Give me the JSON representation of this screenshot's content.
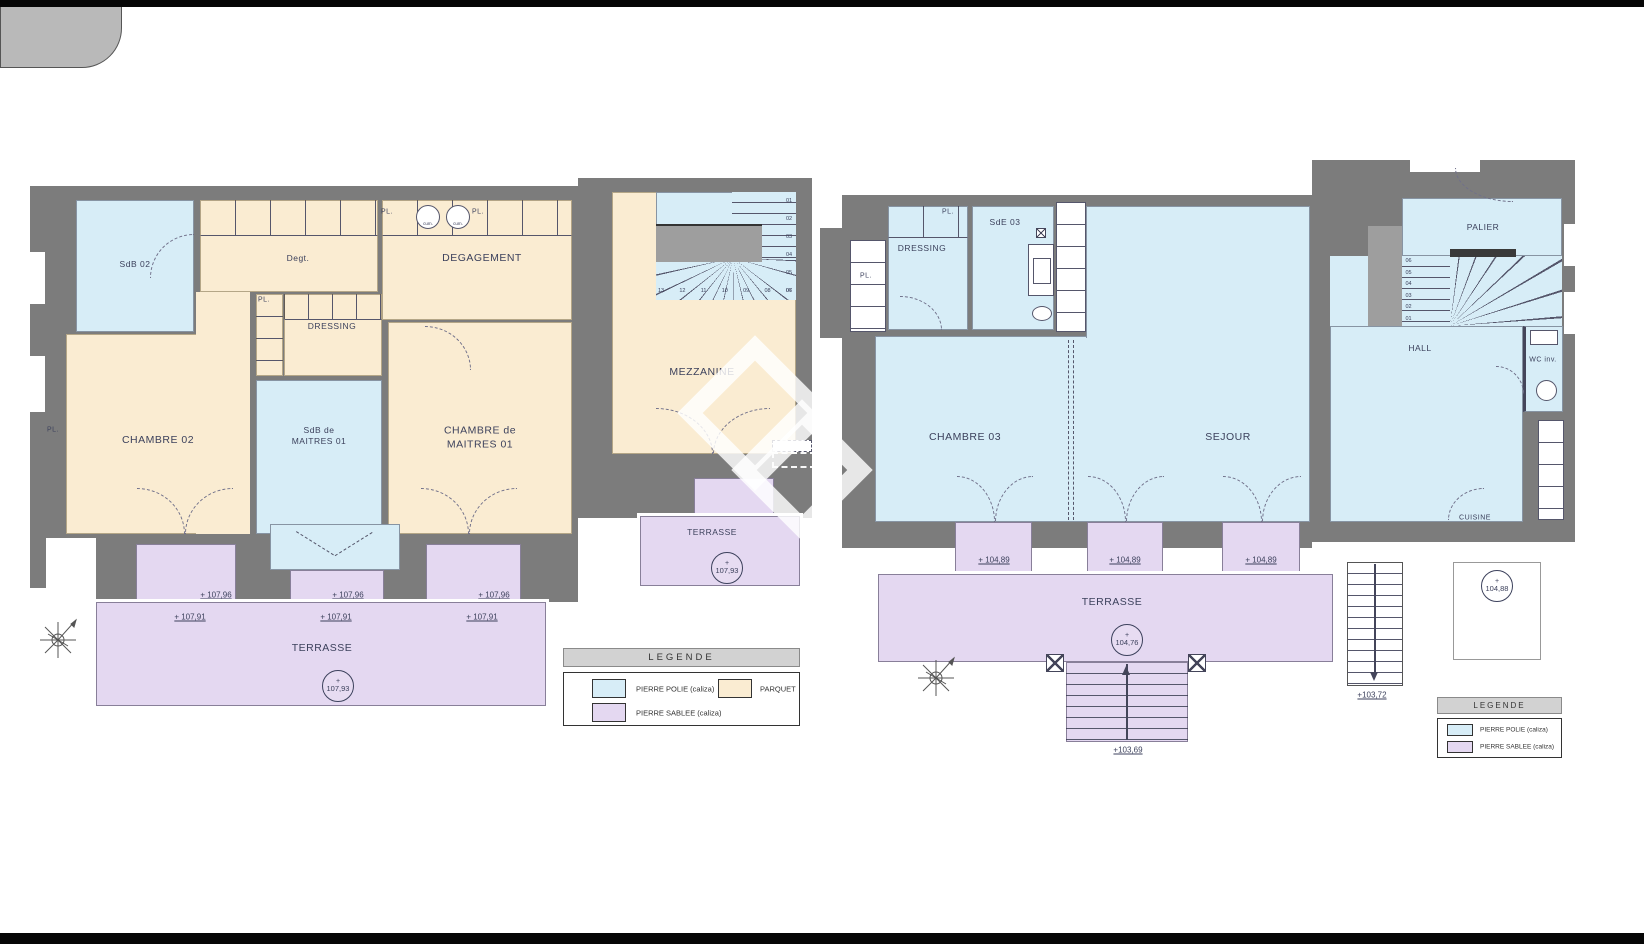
{
  "plus": "+",
  "colors": {
    "wall": "#7c7c7c",
    "pierre_polie": "#d7edf7",
    "parquet": "#faecd2",
    "pierre_sablee": "#e4d8f1",
    "text": "#3c415c"
  },
  "left": {
    "rooms": {
      "sdb02": "SdB 02",
      "degt": "Degt.",
      "degagement": "DEGAGEMENT",
      "dressing": "DRESSING",
      "chambre02": "CHAMBRE 02",
      "sdb_maitres": "SdB de MAITRES 01",
      "chambre_maitres": "CHAMBRE de MAITRES 01",
      "mezzanine": "MEZZANINE",
      "terrasse_small": "TERRASSE",
      "terrasse": "TERRASSE"
    },
    "pl": [
      "PL.",
      "PL.",
      "PL.",
      "PL."
    ],
    "cum": [
      "cum.",
      "cum."
    ],
    "stairs_bottom": [
      "13",
      "12",
      "11",
      "10",
      "09",
      "08",
      "07"
    ],
    "stairs_right": [
      "01",
      "02",
      "03",
      "04",
      "05",
      "06"
    ],
    "elev": {
      "circle_small": "107,93",
      "circle_main": "107,93",
      "e96": [
        "+ 107,96",
        "+ 107,96",
        "+ 107,96"
      ],
      "e91": [
        "+ 107,91",
        "+ 107,91",
        "+ 107,91"
      ]
    },
    "legend": {
      "title": "LEGENDE",
      "items": [
        {
          "label": "PIERRE POLIE (caliza)",
          "color": "#d7edf7"
        },
        {
          "label": "PIERRE SABLEE (caliza)",
          "color": "#e4d8f1"
        },
        {
          "label": "PARQUET",
          "color": "#faecd2"
        }
      ]
    }
  },
  "right": {
    "rooms": {
      "dressing": "DRESSING",
      "sde03": "SdE 03",
      "palier": "PALIER",
      "hall": "HALL",
      "wc": "WC inv.",
      "chambre03": "CHAMBRE 03",
      "sejour": "SEJOUR",
      "cuisine": "CUISINE",
      "terrasse": "TERRASSE"
    },
    "pl": [
      "PL.",
      "PL."
    ],
    "stairs_left": [
      "06",
      "05",
      "04",
      "03",
      "02",
      "01"
    ],
    "elev": {
      "steps": [
        "+ 104,89",
        "+ 104,89",
        "+ 104,89"
      ],
      "circle_terrasse": "104,76",
      "circle_lower": "104,88",
      "stair_right": "+103,72",
      "stair_bottom": "+103,69"
    },
    "legend": {
      "title": "LEGENDE",
      "items": [
        {
          "label": "PIERRE POLIE (caliza)",
          "color": "#d7edf7"
        },
        {
          "label": "PIERRE SABLEE (caliza)",
          "color": "#e4d8f1"
        }
      ]
    }
  }
}
